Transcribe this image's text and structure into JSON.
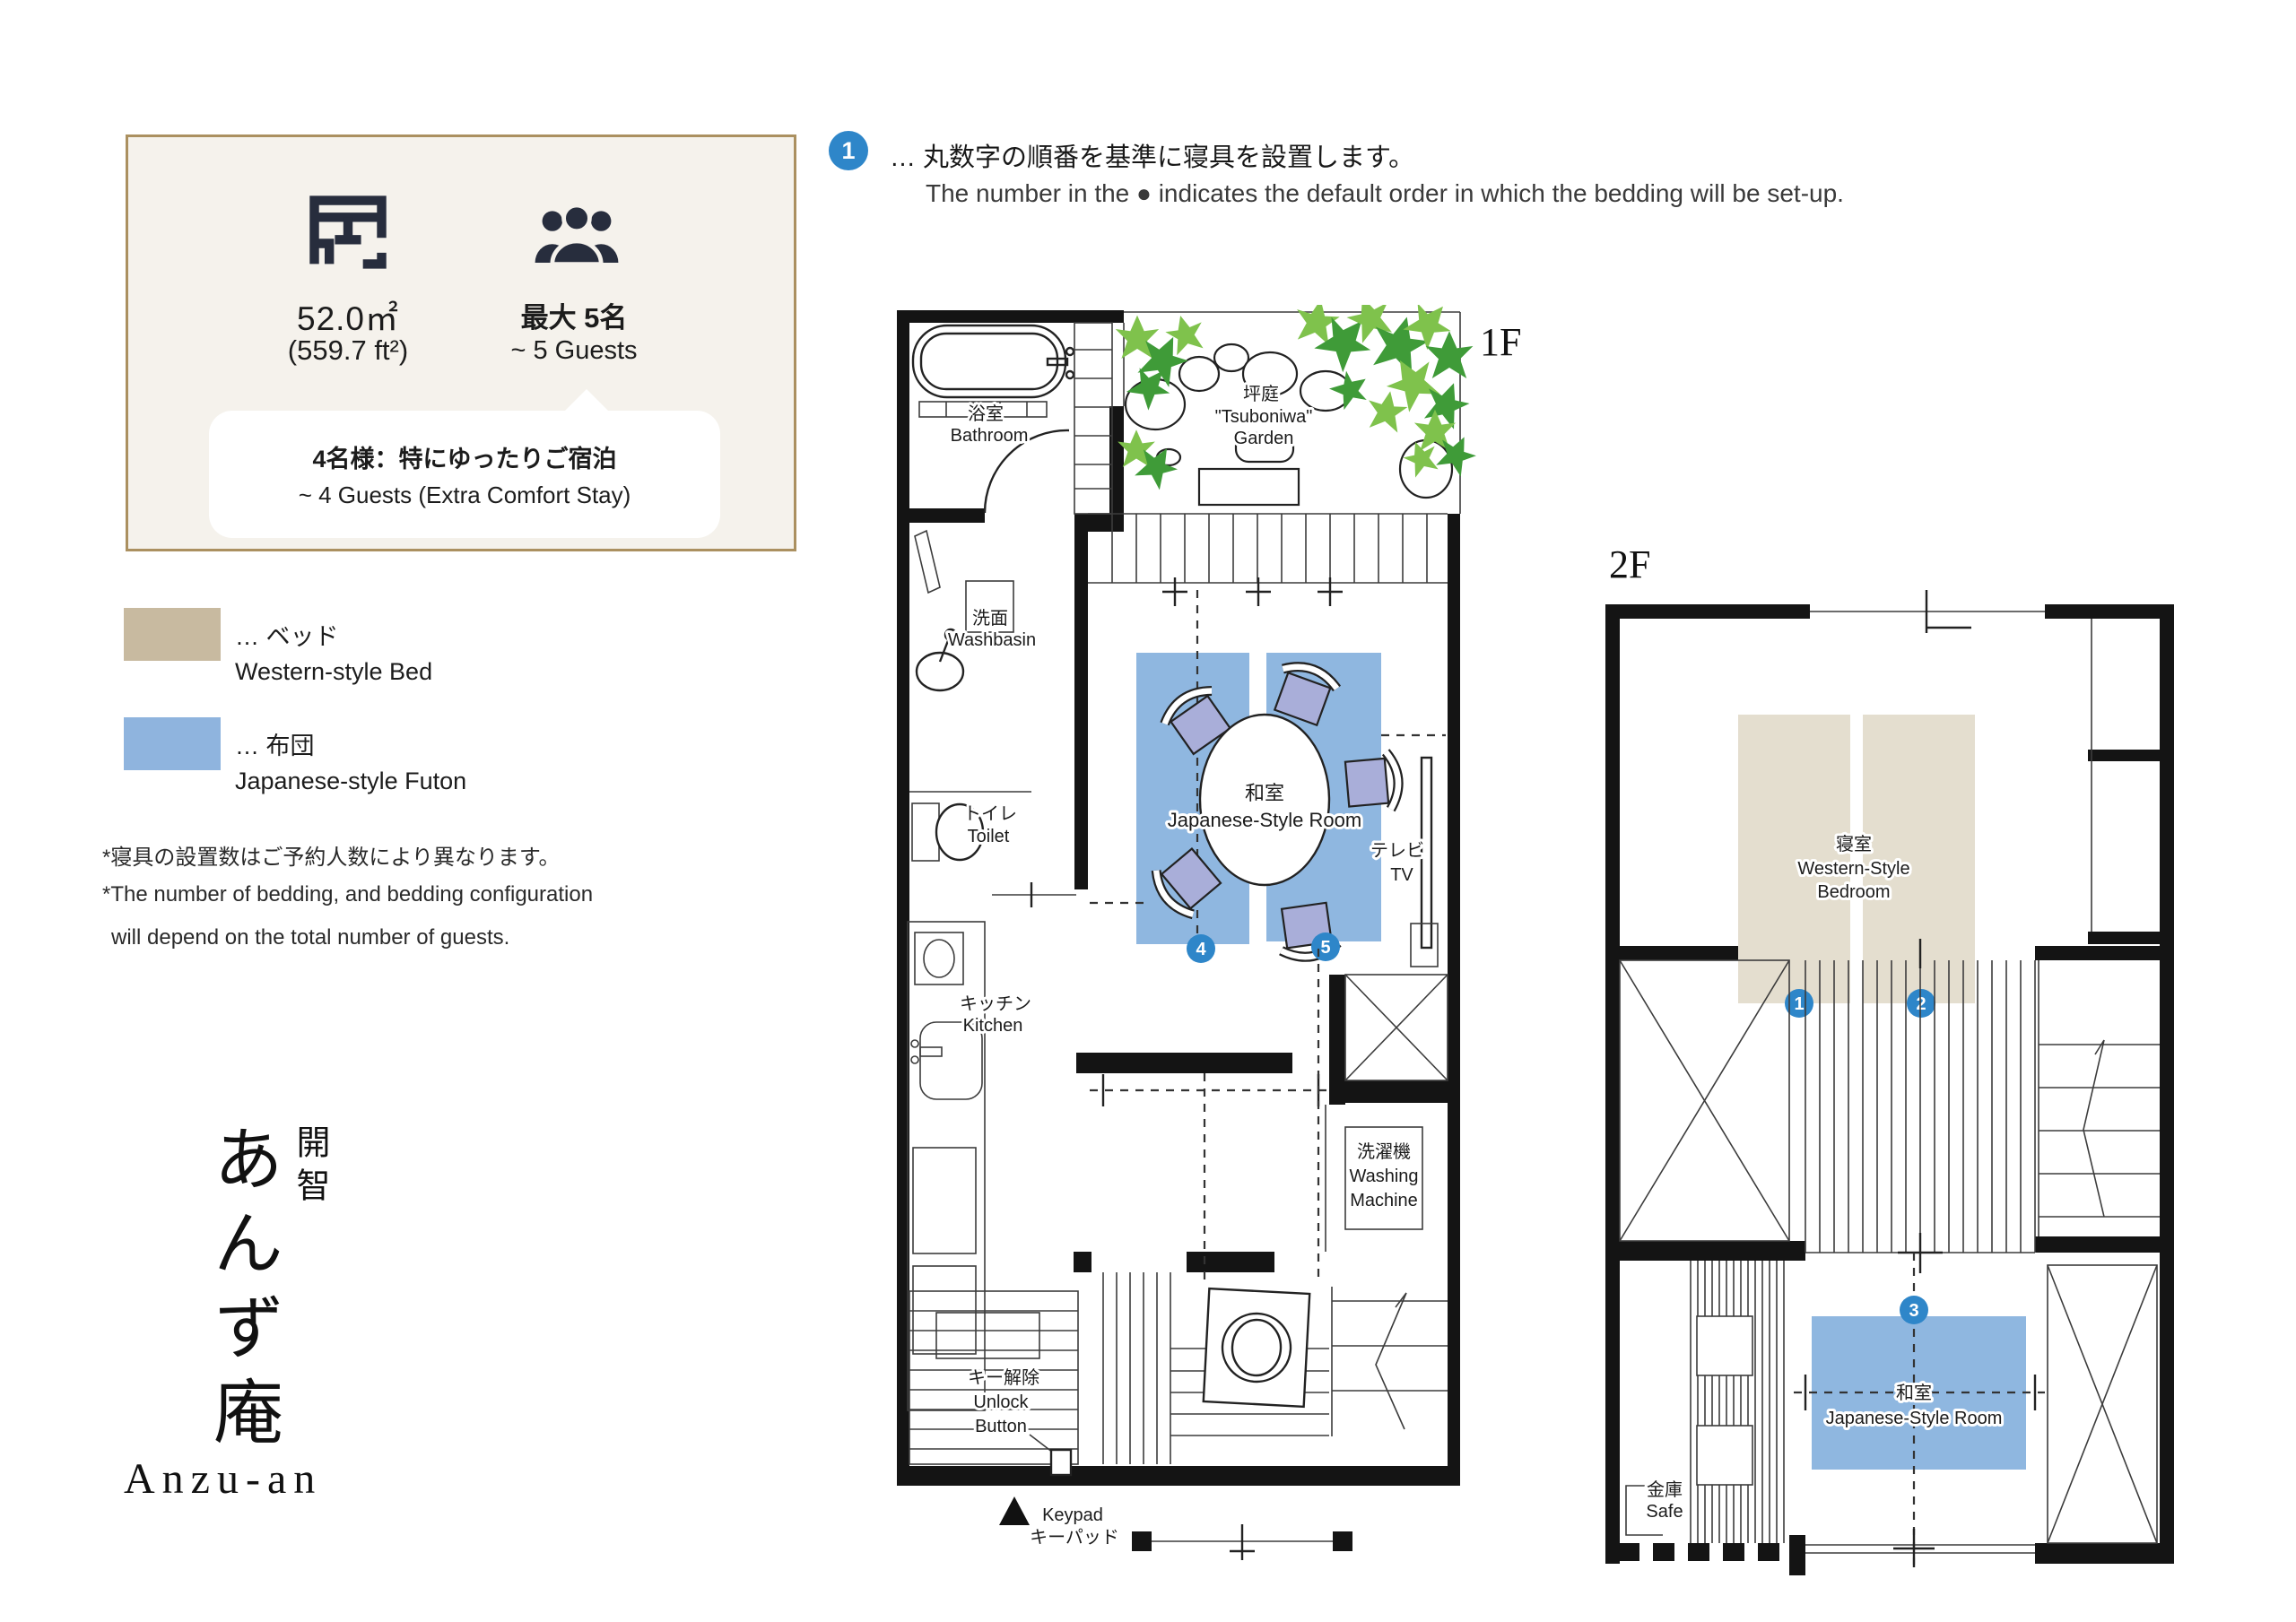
{
  "info_card": {
    "area_value": "52.0㎡",
    "area_alt": "(559.7 ft²)",
    "capacity_jp": "最大 5名",
    "capacity_en": "~ 5 Guests",
    "bubble_jp": "4名様：特にゆったりご宿泊",
    "bubble_en": "~ 4 Guests (Extra Comfort Stay)"
  },
  "legend": {
    "bed_jp": "… ベッド",
    "bed_en": "Western-style Bed",
    "bed_color": "#c8baa0",
    "futon_jp": "… 布団",
    "futon_en": "Japanese-style Futon",
    "futon_color": "#8fb4de"
  },
  "notes": {
    "jp": "*寝具の設置数はご予約人数により異なります。",
    "en_line1": "*The number of bedding, and bedding configuration",
    "en_line2": "will depend on the total number of guests."
  },
  "annotation": {
    "badge": "1",
    "jp": "… 丸数字の順番を基準に寝具を設置します。",
    "en": "The number in the ● indicates the default order in which the bedding will be set-up."
  },
  "brand": {
    "name_jp": "あんず庵",
    "prefix_jp": "開智",
    "name_en": "Anzu-an"
  },
  "floor1": {
    "label": "1F",
    "bathroom_jp": "浴室",
    "bathroom_en": "Bathroom",
    "garden_jp": "坪庭",
    "garden_en1": "\"Tsuboniwa\"",
    "garden_en2": "Garden",
    "washbasin_jp": "洗面",
    "washbasin_en": "Washbasin",
    "toilet_jp": "トイレ",
    "toilet_en": "Toilet",
    "kitchen_jp": "キッチン",
    "kitchen_en": "Kitchen",
    "room_jp": "和室",
    "room_en": "Japanese-Style Room",
    "tv_jp": "テレビ",
    "tv_en": "TV",
    "washing_jp": "洗濯機",
    "washing_en1": "Washing",
    "washing_en2": "Machine",
    "unlock_jp": "キー解除",
    "unlock_en1": "Unlock",
    "unlock_en2": "Button",
    "keypad_en": "Keypad",
    "keypad_jp": "キーパッド",
    "badge_a": "4",
    "badge_b": "5"
  },
  "floor2": {
    "label": "2F",
    "bedroom_jp": "寝室",
    "bedroom_en1": "Western-Style",
    "bedroom_en2": "Bedroom",
    "room_jp": "和室",
    "room_en": "Japanese-Style Room",
    "safe_jp": "金庫",
    "safe_en": "Safe",
    "badge_a": "1",
    "badge_b": "2",
    "badge_c": "3"
  },
  "colors": {
    "badge_blue": "#2e86c9",
    "bed_fill": "#e4decf",
    "futon_fill": "#8fb7e0",
    "icon_navy": "#272d3d",
    "card_bg": "#f5f2ec",
    "card_border": "#ab9060"
  }
}
